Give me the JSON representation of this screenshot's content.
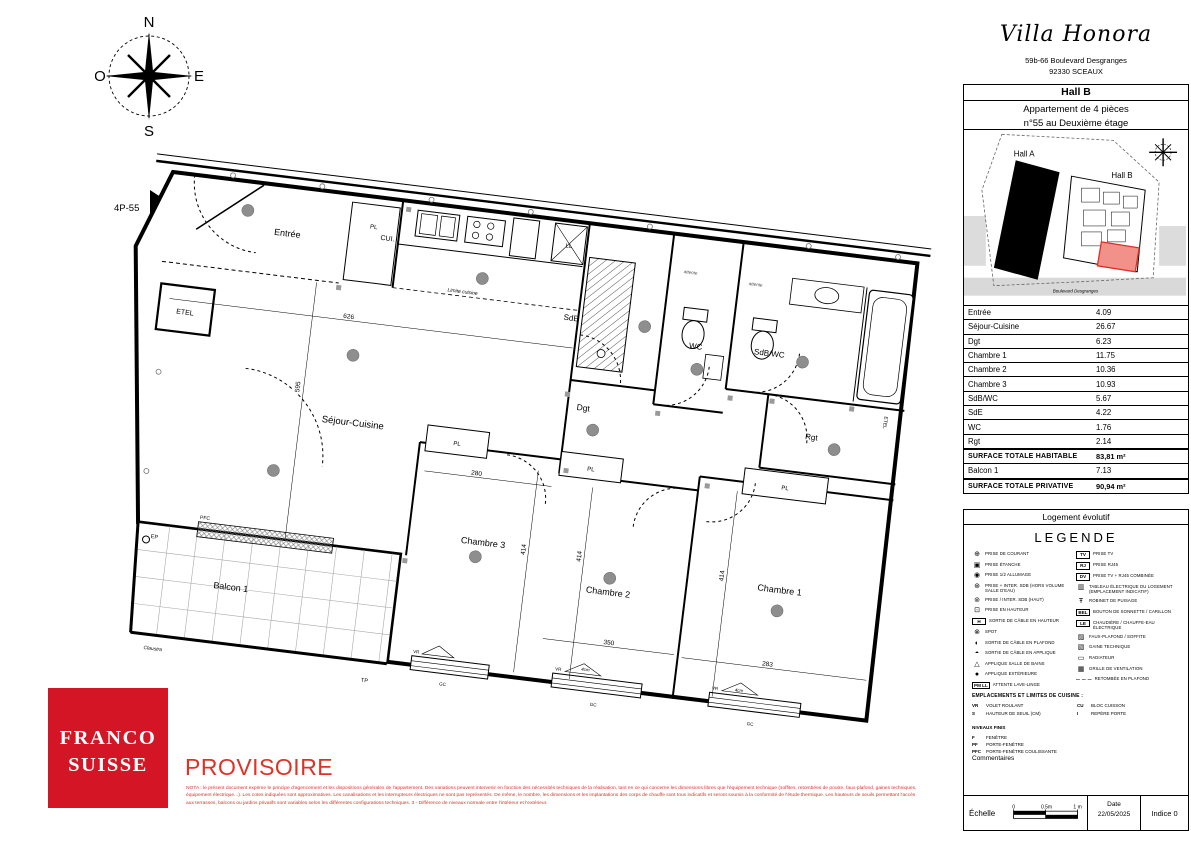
{
  "header": {
    "brand": "Villa Honora",
    "address_line1": "59b-66 Boulevard Desgranges",
    "address_line2": "92330 SCEAUX",
    "hall": "Hall B",
    "apartment_line1": "Appartement de 4 pièces",
    "apartment_line2": "n°55 au Deuxième étage"
  },
  "site_plan": {
    "hall_a": "Hall A",
    "hall_b": "Hall B",
    "street": "Boulevard Desgranges",
    "highlight_fill": "#f19189",
    "highlight_stroke": "#dc2f23"
  },
  "compass": {
    "n": "N",
    "e": "E",
    "s": "S",
    "o": "O"
  },
  "plan": {
    "unit_ref": "4P-55",
    "rooms": {
      "entree": "Entrée",
      "cuisine": "CUI.",
      "etel": "ETEL",
      "sejour": "Séjour-Cuisine",
      "sde": "SdE",
      "wc": "WC",
      "sdbwc": "SdB/WC",
      "dgt": "Dgt",
      "rgt": "Rgt",
      "ch1": "Chambre 1",
      "ch2": "Chambre 2",
      "ch3": "Chambre 3",
      "balcon": "Balcon 1"
    },
    "annotations": {
      "pl": "PL",
      "ll": "LL",
      "attente": "attente",
      "limite_cuisine": "Limite cuisine",
      "pfc": "PFC",
      "vr": "VR",
      "gc": "GC",
      "tp": "TP",
      "ep": "EP",
      "claustra": "Claustra",
      "seuil": "4cm",
      "etel_vert": "ETEL"
    },
    "dims": {
      "d626": "626",
      "d595": "595",
      "d280": "280",
      "d350": "350",
      "d283": "283",
      "d414": "414"
    }
  },
  "areas": {
    "rows": [
      {
        "label": "Entrée",
        "value": "4.09"
      },
      {
        "label": "Séjour-Cuisine",
        "value": "26.67"
      },
      {
        "label": "Dgt",
        "value": "6.23"
      },
      {
        "label": "Chambre 1",
        "value": "11.75"
      },
      {
        "label": "Chambre 2",
        "value": "10.36"
      },
      {
        "label": "Chambre 3",
        "value": "10.93"
      },
      {
        "label": "SdB/WC",
        "value": "5.67"
      },
      {
        "label": "SdE",
        "value": "4.22"
      },
      {
        "label": "WC",
        "value": "1.76"
      },
      {
        "label": "Rgt",
        "value": "2.14"
      },
      {
        "label": "SURFACE TOTALE HABITABLE",
        "value": "83,81 m²",
        "cls": "total"
      },
      {
        "label": "Balcon 1",
        "value": "7.13"
      },
      {
        "label": "SURFACE TOTALE PRIVATIVE",
        "value": "90,94 m²",
        "cls": "total"
      }
    ]
  },
  "legend": {
    "box_title": "Logement évolutif",
    "title": "LEGENDE",
    "left": [
      {
        "icon": "socket-icon",
        "glyph": "⊕",
        "label": "Prise de courant"
      },
      {
        "icon": "sealed-socket-icon",
        "glyph": "▣",
        "label": "Prise étanche"
      },
      {
        "icon": "half-switch-socket-icon",
        "glyph": "◉",
        "label": "Prise 1/2 allumage"
      },
      {
        "icon": "socket-switch-icon",
        "glyph": "⊛",
        "label": "Prise + inter. SdB (hors volume salle d'eau)"
      },
      {
        "icon": "commanded-socket-icon",
        "glyph": "⊚",
        "label": "Prise / inter. SdB (haut)"
      },
      {
        "icon": "high-socket-icon",
        "glyph": "⊡",
        "label": "Prise en hauteur"
      },
      {
        "icon": "cable-outlet-high-icon",
        "glyph": "H",
        "boxed": true,
        "label": "Sortie de câble en hauteur"
      },
      {
        "icon": "spot-icon",
        "glyph": "⊗",
        "label": "Spot"
      },
      {
        "icon": "ceiling-cable-outlet-icon",
        "glyph": "◐",
        "label": "Sortie de câble en plafond"
      },
      {
        "icon": "wall-cable-outlet-icon",
        "glyph": "◓",
        "label": "Sortie de câble en applique"
      },
      {
        "icon": "bathroom-wall-light-icon",
        "glyph": "△",
        "label": "Applique salle de bains"
      },
      {
        "icon": "outdoor-wall-light-icon",
        "glyph": "●",
        "label": "Applique extérieure"
      },
      {
        "icon": "washing-machine-outlet-icon",
        "glyph": "PM LL",
        "boxed": true,
        "label": "Attente lave-linge"
      }
    ],
    "right": [
      {
        "icon": "tv-socket-icon",
        "glyph": "TV",
        "boxed": true,
        "label": "Prise TV"
      },
      {
        "icon": "rj45-socket-icon",
        "glyph": "RJ",
        "boxed": true,
        "label": "Prise RJ45"
      },
      {
        "icon": "tv-rj45-socket-icon",
        "glyph": "DV",
        "boxed": true,
        "label": "Prise TV + RJ45 combinée"
      },
      {
        "icon": "electrical-panel-icon",
        "glyph": "▥",
        "label": "Tableau électrique du logement (emplacement indicatif)"
      },
      {
        "icon": "tap-icon",
        "glyph": "Ŧ",
        "label": "Robinet de puisage"
      },
      {
        "icon": "doorbell-icon",
        "glyph": "BEL",
        "boxed": true,
        "label": "Bouton de sonnette / carillon"
      },
      {
        "icon": "water-heater-icon",
        "glyph": "LE",
        "boxed": true,
        "label": "Chaudière / chauffe-eau électrique"
      },
      {
        "icon": "false-ceiling-icon",
        "glyph": "▨",
        "label": "Faux-plafond / soffite"
      },
      {
        "icon": "duct-icon",
        "glyph": "▧",
        "label": "Gaine technique"
      },
      {
        "icon": "radiator-icon",
        "glyph": "▭",
        "label": "Radiateur"
      },
      {
        "icon": "vent-grille-icon",
        "glyph": "▦",
        "label": "Grille de ventilation"
      },
      {
        "icon": "beam-drop-icon",
        "glyph": "– – –",
        "label": "Retombée en plafond"
      }
    ],
    "kitchen": {
      "header": "EMPLACEMENTS ET LIMITES DE CUISINE :",
      "pairs": [
        {
          "a": "VR",
          "l": "Volet roulant"
        },
        {
          "a": "CU",
          "l": "Bloc cuisson"
        },
        {
          "a": "S",
          "l": "Hauteur de seuil (cm)"
        },
        {
          "a": "I",
          "l": "Repère porte"
        }
      ],
      "levels": "NIVEAUX FINIS",
      "openings": [
        {
          "a": "F",
          "l": "Fenêtre"
        },
        {
          "a": "PF",
          "l": "Porte-fenêtre"
        },
        {
          "a": "PFC",
          "l": "Porte-fenêtre coulissante"
        }
      ],
      "comments": "Commentaires"
    }
  },
  "footer": {
    "logo_line1": "FRANCO",
    "logo_line2": "SUISSE",
    "status": "PROVISOIRE",
    "nota": "NOTA : le présent document exprime le principe d'agencement et les dispositions générales de l'appartement. Des variations peuvent intervenir en fonction des nécessités techniques de la réalisation, tant en ce qui concerne les dimensions libres que l'équipement technique (soffites, retombées de poutre, faux-plafond, gaines techniques, équipement électrique...). Les cotes indiquées sont approximatives. Les canalisations et les interrupteurs électriques ne sont pas représentés. De même, le nombre, les dimensions et les implantations des corps de chauffe sont tous indicatifs et seront soumis à la conformité de l'étude thermique. Les hauteurs de seuils permettant l'accès aux terrasses, balcons ou jardins privatifs sont variables selon les différentes configurations techniques. 3 - Différence de niveaux normale entre l'intérieur et l'extérieur.",
    "scale": {
      "label": "Échelle",
      "t0": "0",
      "t1": "0.5m",
      "t2": "1 m"
    },
    "date_label": "Date",
    "date_value": "22/05/2025",
    "indice": "Indice 0",
    "brand_red": "#d31526",
    "provisional_red": "#e03126"
  }
}
